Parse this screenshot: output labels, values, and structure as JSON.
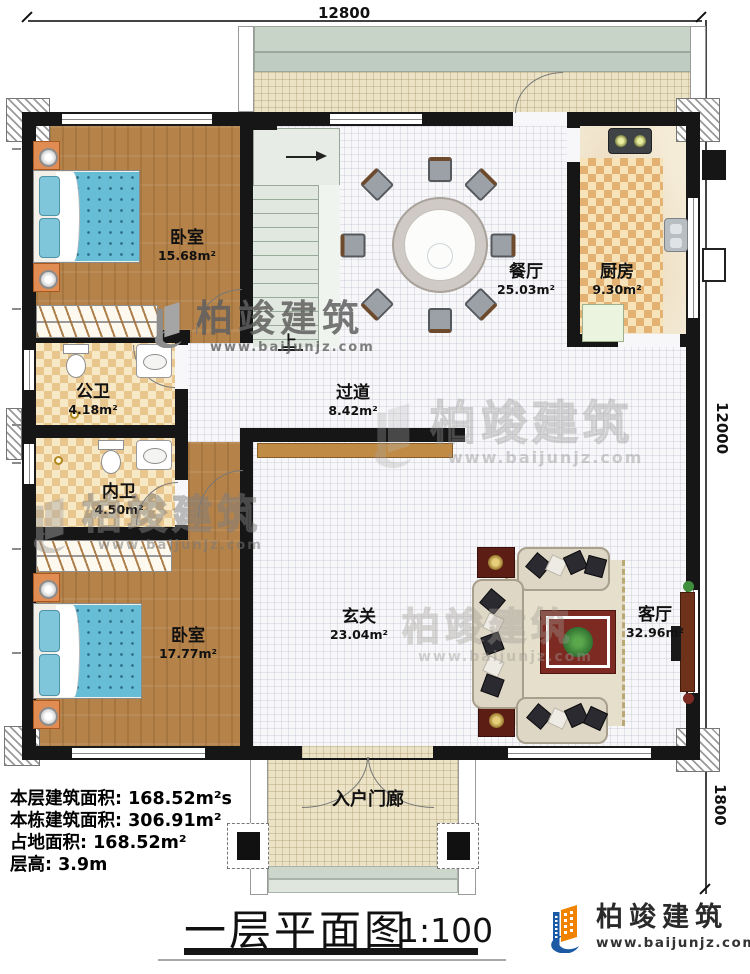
{
  "plan": {
    "dims": {
      "top": "12800",
      "right_main": "12000",
      "right_porch": "1800"
    },
    "rooms": {
      "bedroom1": {
        "name": "卧室",
        "area": "15.68m²"
      },
      "dining": {
        "name": "餐厅",
        "area": "25.03m²"
      },
      "kitchen": {
        "name": "厨房",
        "area": "9.30m²"
      },
      "public_bath": {
        "name": "公卫",
        "area": "4.18m²"
      },
      "hallway": {
        "name": "过道",
        "area": "8.42m²"
      },
      "private_bath": {
        "name": "内卫",
        "area": "4.50m²"
      },
      "bedroom2": {
        "name": "卧室",
        "area": "17.77m²"
      },
      "foyer": {
        "name": "玄关",
        "area": "23.04m²"
      },
      "living": {
        "name": "客厅",
        "area": "32.96m²"
      },
      "porch": {
        "name": "入户门廊"
      }
    },
    "stairs_label": "上"
  },
  "stats": {
    "lines": [
      {
        "label": "本层建筑面积:",
        "value": "168.52m²s"
      },
      {
        "label": "本栋建筑面积:",
        "value": "306.91m²"
      },
      {
        "label": "占地面积:",
        "value": "168.52m²"
      },
      {
        "label": "层高:",
        "value": "3.9m"
      }
    ]
  },
  "title_block": {
    "title": "一层平面图",
    "scale": "1:100"
  },
  "brand": {
    "name": "柏竣建筑",
    "url": "www.baijunjz.com"
  },
  "watermark": {
    "name": "柏竣建筑",
    "url": "www.baijunjz.com"
  },
  "colors": {
    "brand_blue": "#1c5aa5",
    "brand_orange": "#f08300",
    "wall": "#161616",
    "wood_floor": "#b5834a",
    "bath_tile": "#e9c68e",
    "bed_blue": "#68bdd6"
  }
}
